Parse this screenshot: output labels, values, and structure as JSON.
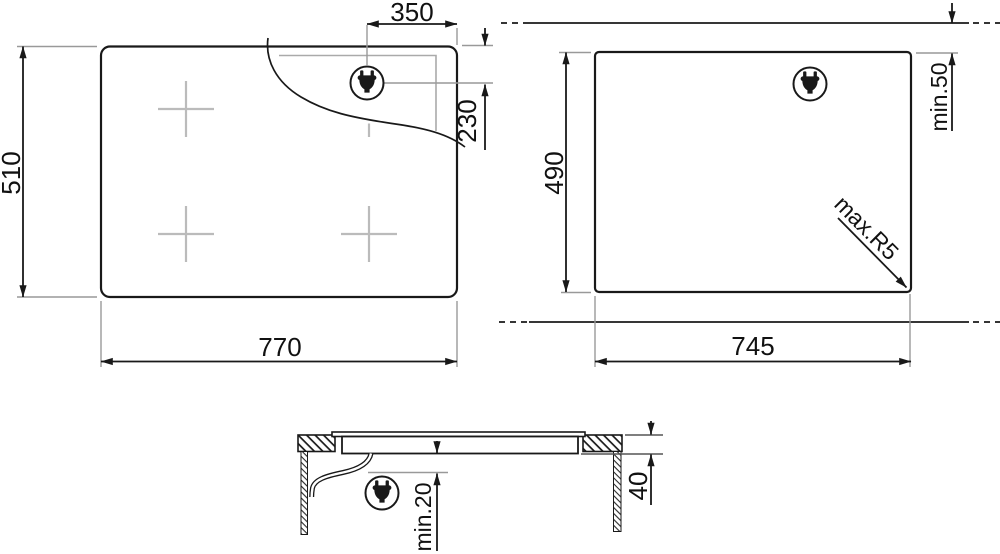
{
  "drawing": {
    "kind": "hob installation dimensions",
    "top_view": {
      "width_label": "770",
      "height_label": "510",
      "plug_offset_x_label": "350",
      "plug_offset_y_label": "230"
    },
    "cutout_view": {
      "width_label": "745",
      "height_label": "490",
      "top_clearance_label": "min.50",
      "corner_radius_label": "max.R5"
    },
    "side_view": {
      "recess_depth_label": "40",
      "bottom_clearance_label": "min.20"
    }
  },
  "icons": {
    "plug": "power-plug-icon"
  },
  "colors": {
    "line": "#191919",
    "extension_line": "#999999",
    "burner_cross": "#bbbbbb",
    "background": "#ffffff"
  }
}
